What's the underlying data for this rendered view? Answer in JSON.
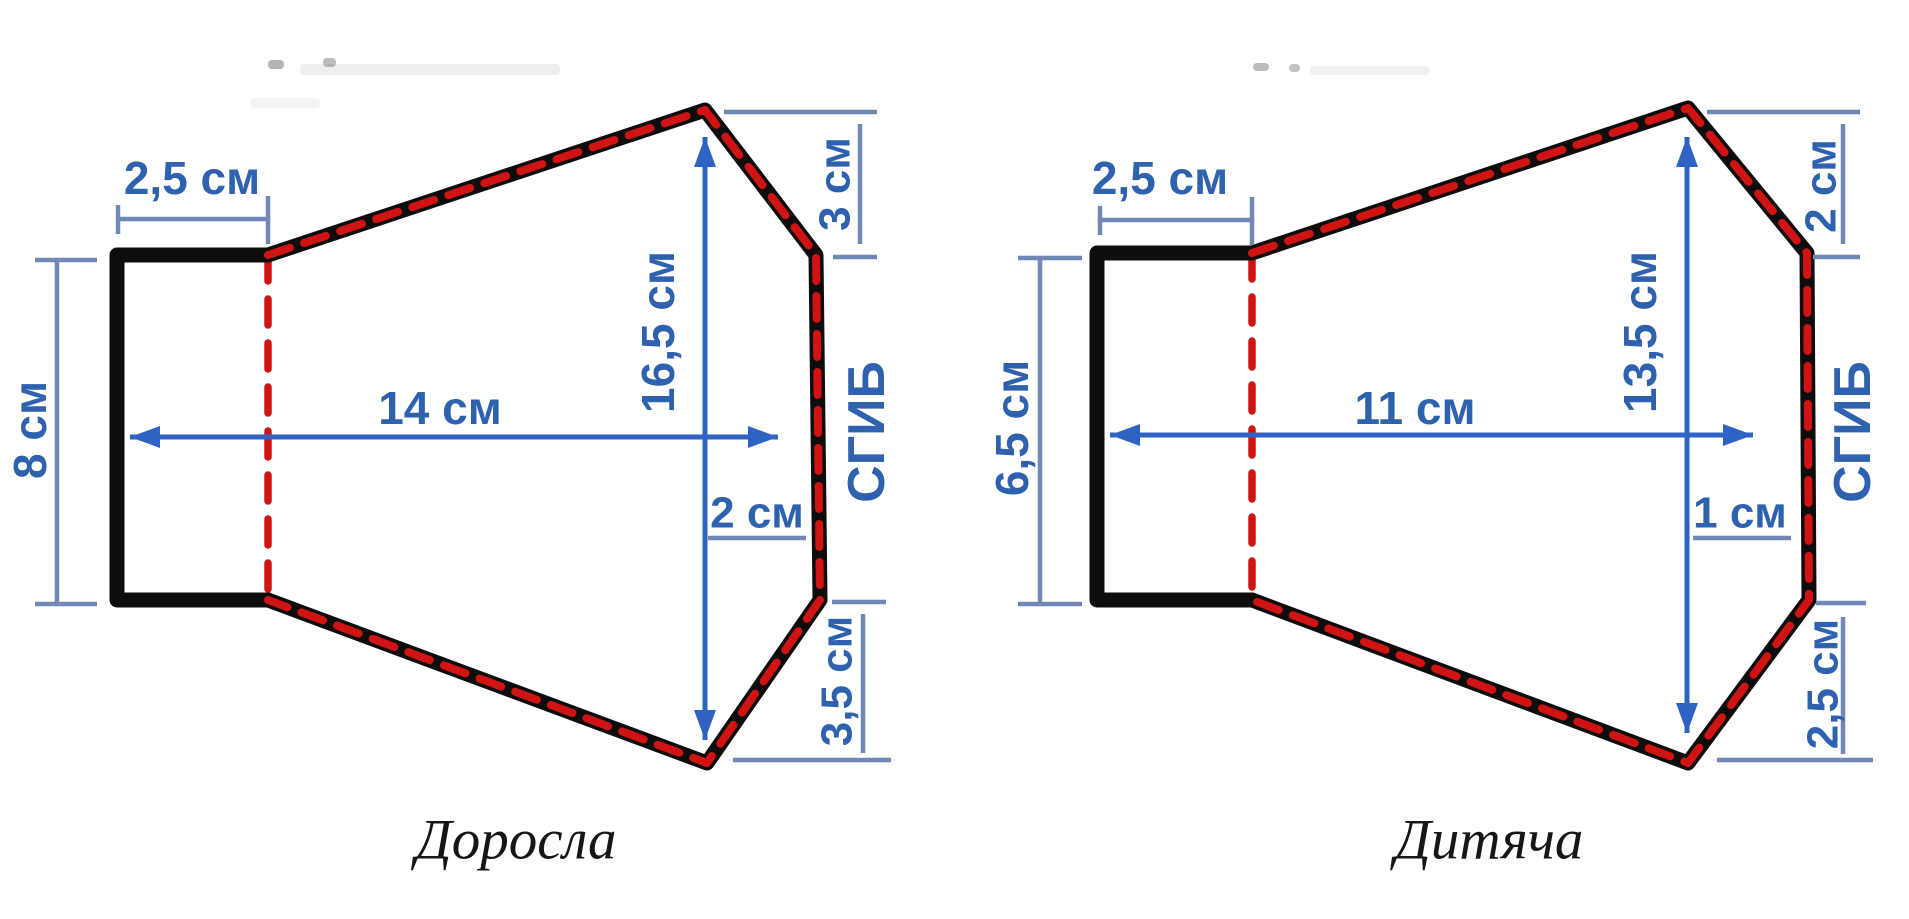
{
  "canvas": {
    "w": 1909,
    "h": 919
  },
  "colors": {
    "outline": "#0d0d0d",
    "seam": "#d01414",
    "dimText": "#2e61ae",
    "dimLine": "#7188b5",
    "arrow": "#2e63c3",
    "artifact": "#777777",
    "caption": "#161616",
    "background": "#ffffff"
  },
  "artifacts": [
    {
      "x": 268,
      "y": 60,
      "w": 16,
      "h": 9,
      "o": 0.55
    },
    {
      "x": 323,
      "y": 58,
      "w": 13,
      "h": 9,
      "o": 0.5
    },
    {
      "x": 300,
      "y": 64,
      "w": 260,
      "h": 11,
      "o": 0.12
    },
    {
      "x": 250,
      "y": 98,
      "w": 70,
      "h": 10,
      "o": 0.08
    },
    {
      "x": 1253,
      "y": 63,
      "w": 16,
      "h": 8,
      "o": 0.5
    },
    {
      "x": 1289,
      "y": 64,
      "w": 11,
      "h": 8,
      "o": 0.45
    },
    {
      "x": 1310,
      "y": 66,
      "w": 120,
      "h": 9,
      "o": 0.1
    }
  ],
  "diagrams": [
    {
      "caption": "Доросла",
      "caption_pos": [
        516,
        840
      ],
      "shape": {
        "solid": [
          [
            268,
            255
          ],
          [
            117,
            255
          ],
          [
            117,
            600
          ],
          [
            268,
            600
          ]
        ],
        "seam": [
          [
            268,
            255
          ],
          [
            705,
            110
          ],
          [
            816,
            255
          ],
          [
            820,
            600
          ],
          [
            707,
            763
          ],
          [
            268,
            600
          ]
        ],
        "divider": [
          [
            268,
            255
          ],
          [
            268,
            600
          ]
        ]
      },
      "dims": [
        {
          "label": "2,5 см",
          "x": 192,
          "y": 178,
          "fs": 46,
          "lines": [
            [
              118,
              219,
              268,
              219
            ],
            [
              118,
              205,
              118,
              234
            ],
            [
              268,
              196,
              268,
              244
            ]
          ]
        },
        {
          "label": "8 см",
          "x": 30,
          "y": 430,
          "rot": true,
          "fs": 46,
          "lines": [
            [
              57,
              260,
              57,
              604
            ],
            [
              35,
              260,
              97,
              260
            ],
            [
              35,
              604,
              97,
              604
            ]
          ]
        },
        {
          "label": "14 см",
          "x": 440,
          "y": 408,
          "fs": 46,
          "arrows": [
            [
              130,
              437,
              778,
              437
            ]
          ]
        },
        {
          "label": "16,5 см",
          "x": 658,
          "y": 332,
          "rot": true,
          "fs": 46,
          "arrows": [
            [
              705,
              137,
              705,
              740
            ]
          ]
        },
        {
          "label": "3 см",
          "x": 834,
          "y": 184,
          "rot": true,
          "fs": 44,
          "lines": [
            [
              724,
              112,
              877,
              112
            ],
            [
              860,
              124,
              860,
              244
            ],
            [
              833,
              257,
              877,
              257
            ]
          ]
        },
        {
          "label": "2 см",
          "x": 757,
          "y": 512,
          "fs": 44,
          "lines": [
            [
              708,
              538,
              806,
              538
            ]
          ]
        },
        {
          "label": "3,5 см",
          "x": 836,
          "y": 681,
          "rot": true,
          "fs": 44,
          "lines": [
            [
              863,
              614,
              863,
              753
            ],
            [
              832,
              602,
              886,
              602
            ],
            [
              733,
              760,
              891,
              760
            ]
          ]
        },
        {
          "label": "СГИБ",
          "x": 866,
          "y": 432,
          "rot": true,
          "fs": 52,
          "fold": true
        }
      ]
    },
    {
      "caption": "Дитяча",
      "caption_pos": [
        1489,
        840
      ],
      "shape": {
        "solid": [
          [
            1252,
            253
          ],
          [
            1097,
            253
          ],
          [
            1097,
            600
          ],
          [
            1252,
            600
          ]
        ],
        "seam": [
          [
            1252,
            253
          ],
          [
            1688,
            108
          ],
          [
            1807,
            253
          ],
          [
            1809,
            600
          ],
          [
            1688,
            763
          ],
          [
            1252,
            600
          ]
        ],
        "divider": [
          [
            1252,
            253
          ],
          [
            1252,
            600
          ]
        ]
      },
      "dims": [
        {
          "label": "2,5 см",
          "x": 1160,
          "y": 178,
          "fs": 46,
          "lines": [
            [
              1100,
              220,
              1252,
              220
            ],
            [
              1100,
              206,
              1100,
              235
            ],
            [
              1252,
              197,
              1252,
              245
            ]
          ]
        },
        {
          "label": "6,5 см",
          "x": 1012,
          "y": 428,
          "rot": true,
          "fs": 46,
          "lines": [
            [
              1040,
              258,
              1040,
              604
            ],
            [
              1018,
              258,
              1082,
              258
            ],
            [
              1018,
              604,
              1082,
              604
            ]
          ]
        },
        {
          "label": "11 см",
          "x": 1415,
          "y": 408,
          "fs": 46,
          "arrows": [
            [
              1110,
              435,
              1753,
              435
            ]
          ]
        },
        {
          "label": "13,5 см",
          "x": 1640,
          "y": 332,
          "rot": true,
          "fs": 46,
          "arrows": [
            [
              1687,
              137,
              1687,
              733
            ]
          ]
        },
        {
          "label": "2 см",
          "x": 1820,
          "y": 186,
          "rot": true,
          "fs": 44,
          "lines": [
            [
              1707,
              112,
              1860,
              112
            ],
            [
              1843,
              124,
              1843,
              244
            ],
            [
              1813,
              257,
              1860,
              257
            ]
          ]
        },
        {
          "label": "1 см",
          "x": 1740,
          "y": 512,
          "fs": 44,
          "lines": [
            [
              1693,
              538,
              1791,
              538
            ]
          ]
        },
        {
          "label": "2,5 см",
          "x": 1822,
          "y": 684,
          "rot": true,
          "fs": 44,
          "lines": [
            [
              1843,
              617,
              1843,
              754
            ],
            [
              1816,
              603,
              1866,
              603
            ],
            [
              1717,
              760,
              1873,
              760
            ]
          ]
        },
        {
          "label": "СГИБ",
          "x": 1852,
          "y": 432,
          "rot": true,
          "fs": 52,
          "fold": true
        }
      ]
    }
  ]
}
